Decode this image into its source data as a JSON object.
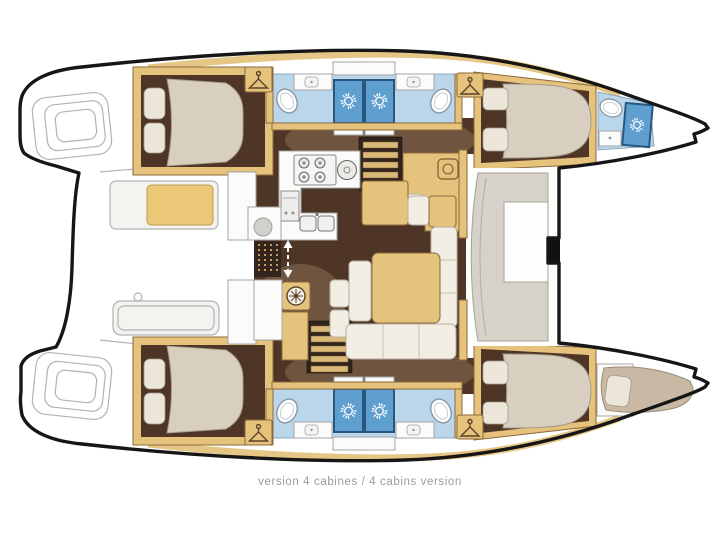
{
  "caption": "version 4 cabines / 4 cabins version",
  "colors": {
    "hull_outline": "#161616",
    "deck_white": "#ffffff",
    "cockpit_line": "#b2b2b2",
    "cockpit_fill": "#f4f3f0",
    "wood": "#e5c37d",
    "wood_dark": "#8a6a3c",
    "floor_dark": "#4e3526",
    "floor_mid": "#8a6f55",
    "counter_white": "#fbfbfa",
    "bath_floor": "#b9d6ea",
    "shower_blue": "#5f9fd0",
    "shower_frame": "#27567f",
    "fixture_line": "#8a97a3",
    "mattress": "#d9cfc0",
    "mattress_line": "#a49a88",
    "pillow": "#ece6da",
    "cushion": "#f2eee3",
    "cushion_line": "#b7b0a2",
    "berth_tan": "#c9b9a4",
    "caption_gray": "#9b9b9b"
  },
  "icons": {
    "shower_drain": "sun-rays",
    "wardrobe": "clothes-hanger",
    "stove": "four-burner-rings",
    "compass_rose": "spoked-dial",
    "entry_door": "double-headed-dashed-arrow"
  }
}
